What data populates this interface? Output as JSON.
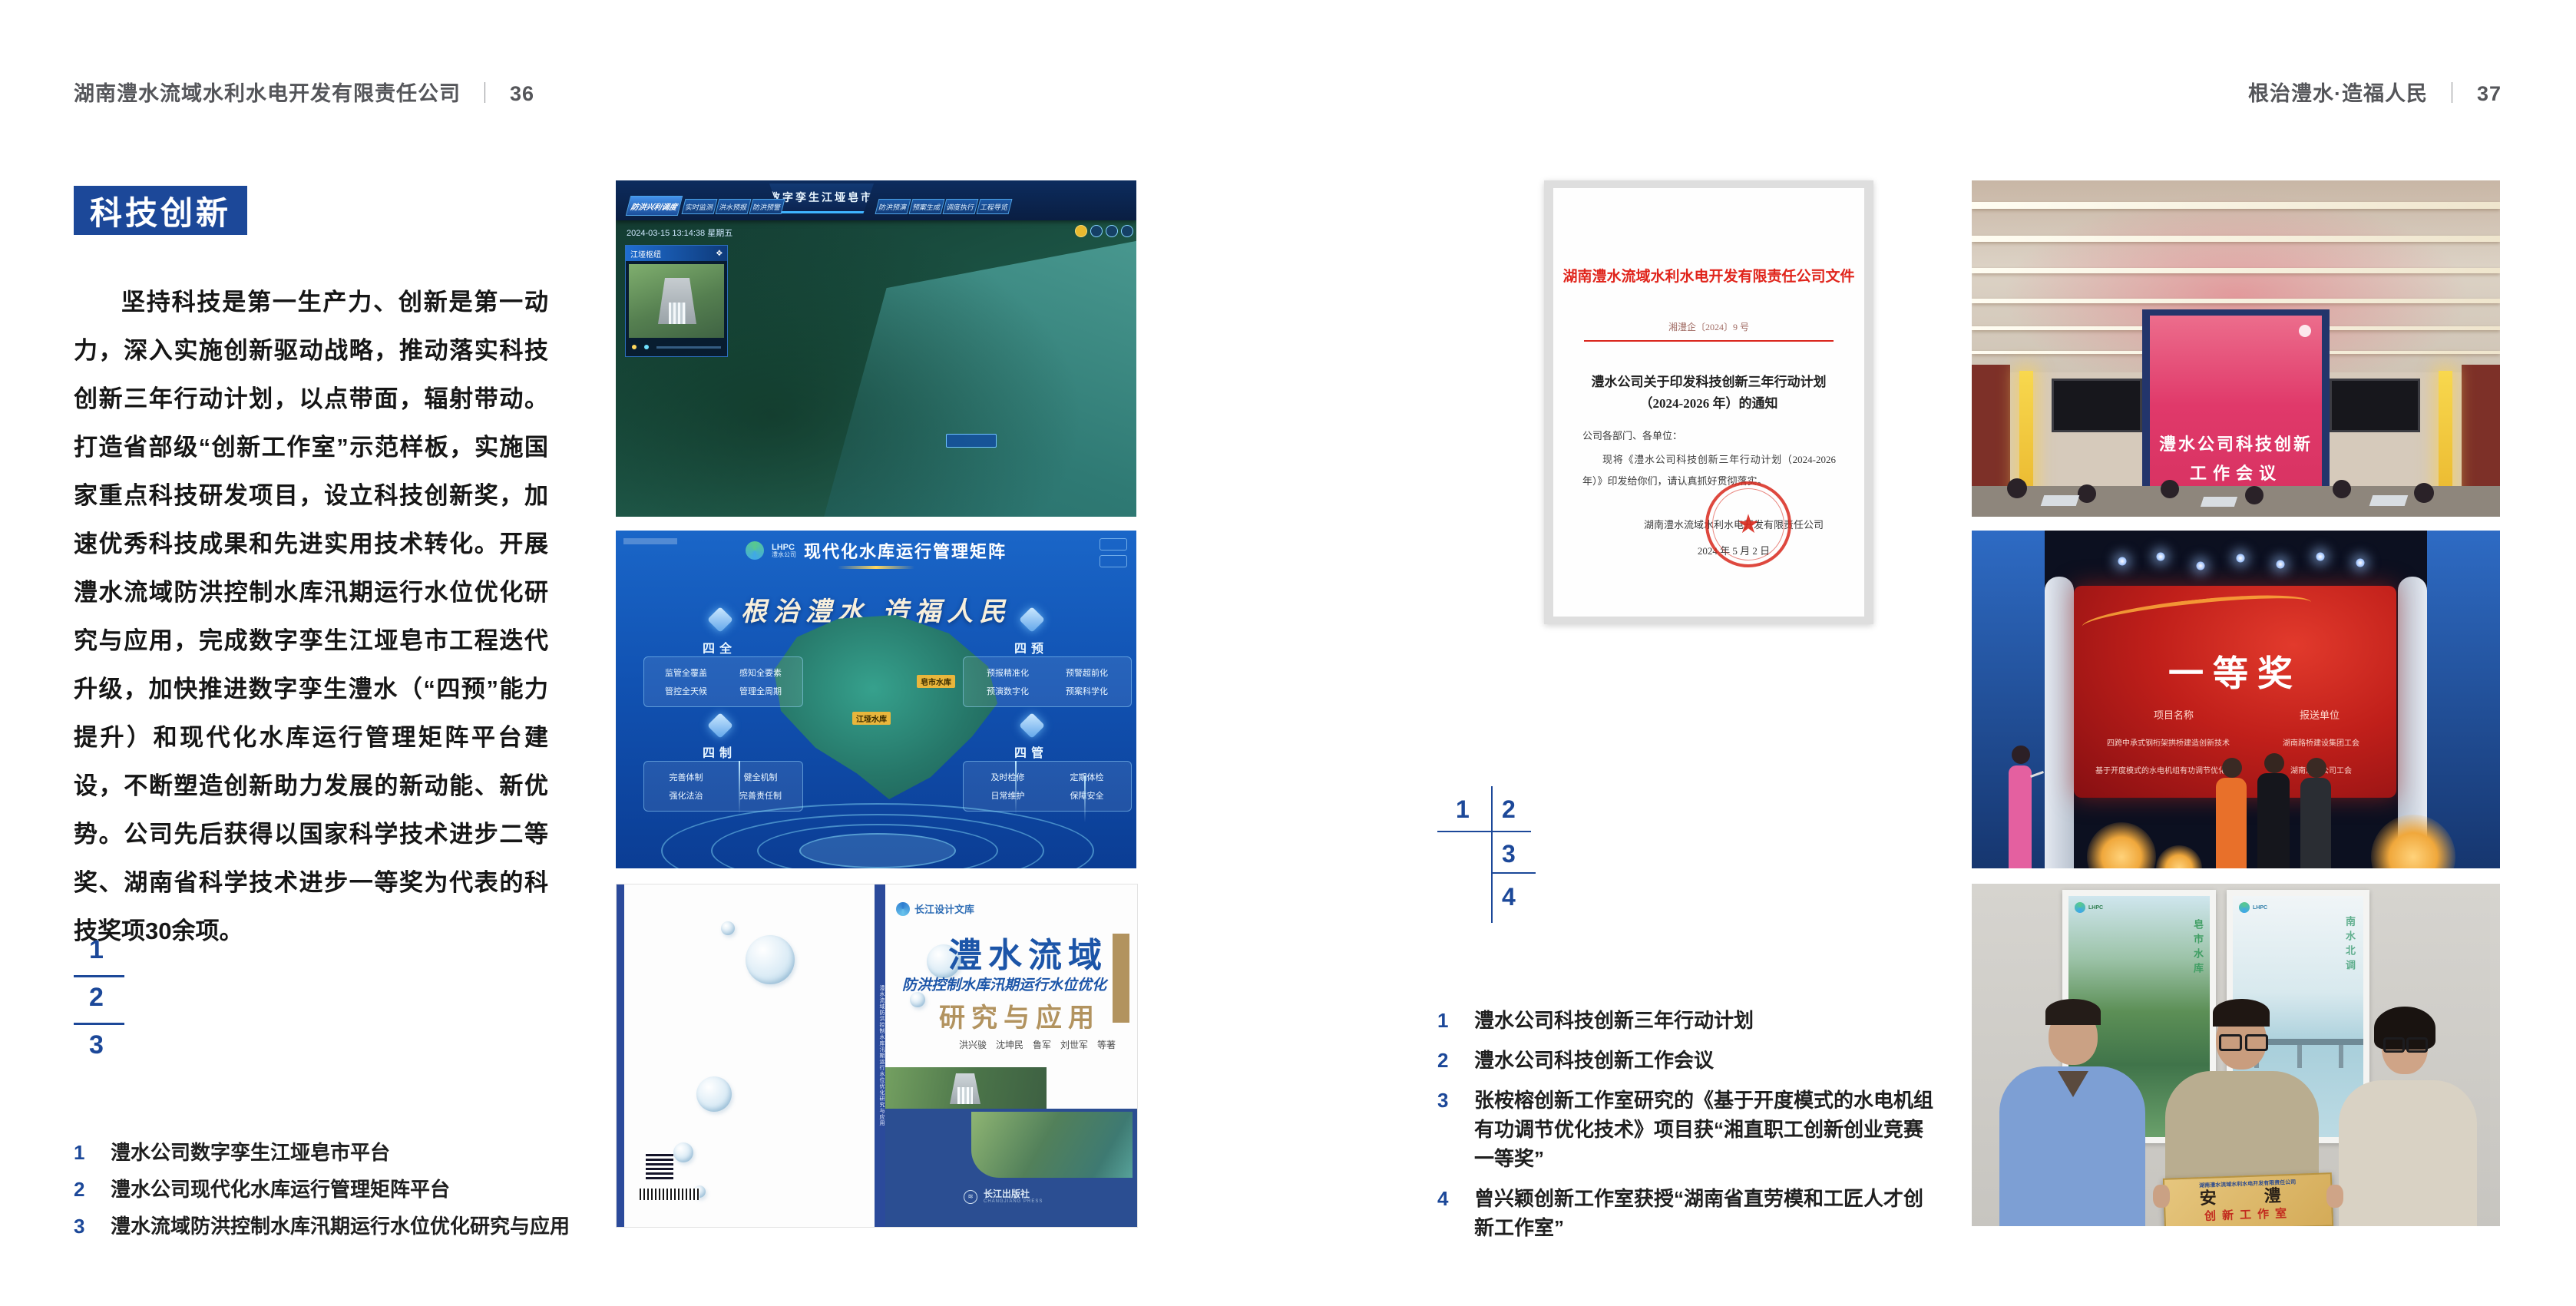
{
  "colors": {
    "brand_blue": "#1c4899",
    "doc_red": "#d9261c",
    "gold": "#b2935f",
    "screen_pink": "#e0396a",
    "award_red": "#b01818"
  },
  "page_left": {
    "header": {
      "title": "湖南澧水流域水利水电开发有限责任公司",
      "sep": "｜",
      "page": "36"
    },
    "badge": "科技创新",
    "paragraph": "坚持科技是第一生产力、创新是第一动力，深入实施创新驱动战略，推动落实科技创新三年行动计划，以点带面，辐射带动。打造省部级“创新工作室”示范样板，实施国家重点科技研发项目，设立科技创新奖，加速优秀科技成果和先进实用技术转化。开展澧水流域防洪控制水库汛期运行水位优化研究与应用，完成数字孪生江垭皂市工程迭代升级，加快推进数字孪生澧水（“四预”能力提升）和现代化水库运行管理矩阵平台建设，不断塑造创新助力发展的新动能、新优势。公司先后获得以国家科学技术进步二等奖、湖南省科学技术进步一等奖为代表的科技奖项30余项。",
    "nums": [
      "1",
      "2",
      "3"
    ],
    "captions": [
      {
        "n": "1",
        "t": "澧水公司数字孪生江垭皂市平台"
      },
      {
        "n": "2",
        "t": "澧水公司现代化水库运行管理矩阵平台"
      },
      {
        "n": "3",
        "t": "澧水流域防洪控制水库汛期运行水位优化研究与应用"
      }
    ],
    "fig_twin": {
      "title": "数字孪生江垭皂市",
      "tab_active": "防洪兴利调度",
      "tabs_left": [
        "实时监测",
        "洪水预报",
        "防洪预警"
      ],
      "tabs_right": [
        "防洪预演",
        "预案生成",
        "调度执行",
        "工程导览"
      ],
      "timestamp": "2024-03-15 13:14:38 星期五",
      "panel_title": "江垭枢纽"
    },
    "fig_matrix": {
      "logo_abbr": "LHPC",
      "logo_name": "澧水公司",
      "title": "现代化水库运行管理矩阵",
      "slogan": "根治澧水 造福人民",
      "groups": [
        {
          "name": "四全",
          "items": [
            "监管全覆盖",
            "感知全要素",
            "管控全天候",
            "管理全周期"
          ]
        },
        {
          "name": "四预",
          "items": [
            "预报精准化",
            "预警超前化",
            "预演数字化",
            "预案科学化"
          ]
        },
        {
          "name": "四制",
          "items": [
            "完善体制",
            "健全机制",
            "强化法治",
            "完善责任制"
          ]
        },
        {
          "name": "四管",
          "items": [
            "及时检修",
            "定期体检",
            "日常维护",
            "保障安全"
          ]
        }
      ],
      "labels": [
        "皂市水库",
        "江垭水库"
      ]
    },
    "fig_book": {
      "series": "长江设计文库",
      "title": "澧水流域",
      "subtitle": "防洪控制水库汛期运行水位优化",
      "subtitle2": "研究与应用",
      "authors": "洪兴骏　沈坤民　鲁军　刘世军　等著",
      "spine": "澧水流域防洪控制水库汛期运行水位优化研究与应用",
      "publisher": "长江出版社",
      "publisher_en": "CHANGJIANG PRESS"
    }
  },
  "page_right": {
    "header": {
      "title": "根治澧水·造福人民",
      "sep": "｜",
      "page": "37"
    },
    "document": {
      "letterhead": "湖南澧水流域水利水电开发有限责任公司文件",
      "doc_no": "湘澧企〔2024〕9 号",
      "title1": "澧水公司关于印发科技创新三年行动计划",
      "title2": "（2024-2026 年）的通知",
      "salutation": "公司各部门、各单位：",
      "body": "现将《澧水公司科技创新三年行动计划（2024-2026 年）》印发给你们，请认真抓好贯彻落实。",
      "signer": "湖南澧水流域水利水电开发有限责任公司",
      "date": "2024 年 5 月 2 日",
      "star": "★"
    },
    "nums": [
      "1",
      "2",
      "3",
      "4"
    ],
    "captions": [
      {
        "n": "1",
        "t": "澧水公司科技创新三年行动计划"
      },
      {
        "n": "2",
        "t": "澧水公司科技创新工作会议"
      },
      {
        "n": "3",
        "t": "张桉榕创新工作室研究的《基于开度模式的水电机组有功调节优化技术》项目获“湘直职工创新创业竞赛一等奖”"
      },
      {
        "n": "4",
        "t": "曾兴颖创新工作室获授“湖南省直劳模和工匠人才创新工作室”"
      }
    ],
    "photo_meeting": {
      "line1": "澧水公司科技创新",
      "line2": "工作会议"
    },
    "photo_award": {
      "award": "一等奖",
      "col1": "项目名称",
      "col2": "报送单位",
      "r1c1": "四跨中承式钢桁架拱桥建造创新技术",
      "r1c2": "湖南路桥建设集团工会",
      "r2c1": "基于开度模式的水电机组有功调节优化技术",
      "r2c2": "湖南澧水公司工会"
    },
    "photo_plaque": {
      "company": "湖南澧水流域水利水电开发有限责任公司",
      "title": "安　澧",
      "sub": "创新工作室",
      "poster1": "皂市水库",
      "poster2": "南水北调",
      "logo_abbr": "LHPC",
      "logo_name": "澧水公司"
    }
  }
}
